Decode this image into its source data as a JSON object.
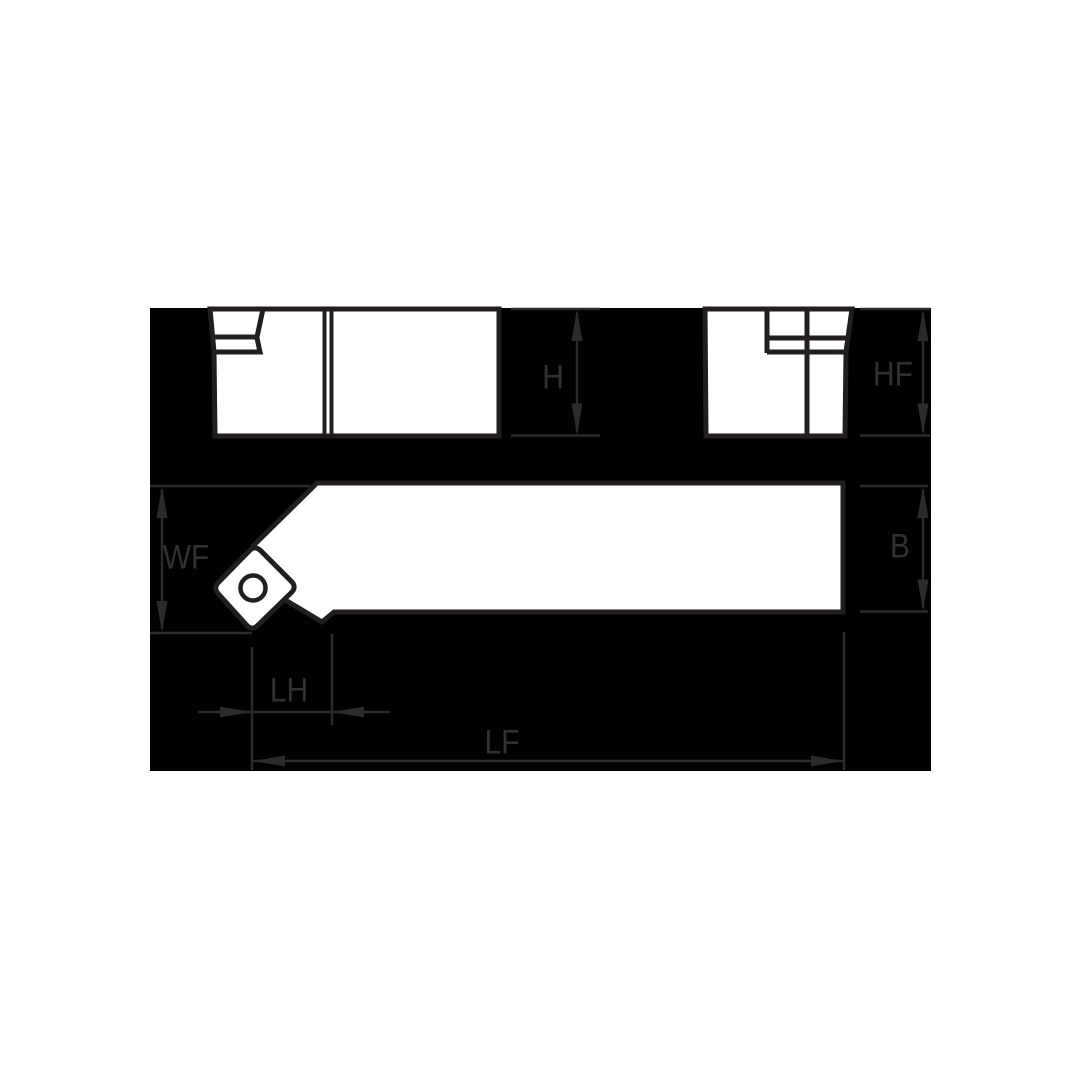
{
  "drawing": {
    "colors": {
      "page_bg": "#ffffff",
      "panel_bg": "#000000",
      "shape_fill": "#ffffff",
      "outline": "#221e1f",
      "dim": "#2e2a2b",
      "label": "#343031"
    },
    "dimension_labels": {
      "h": "H",
      "hf": "HF",
      "wf": "WF",
      "b": "B",
      "lh": "LH",
      "lf": "LF"
    }
  }
}
